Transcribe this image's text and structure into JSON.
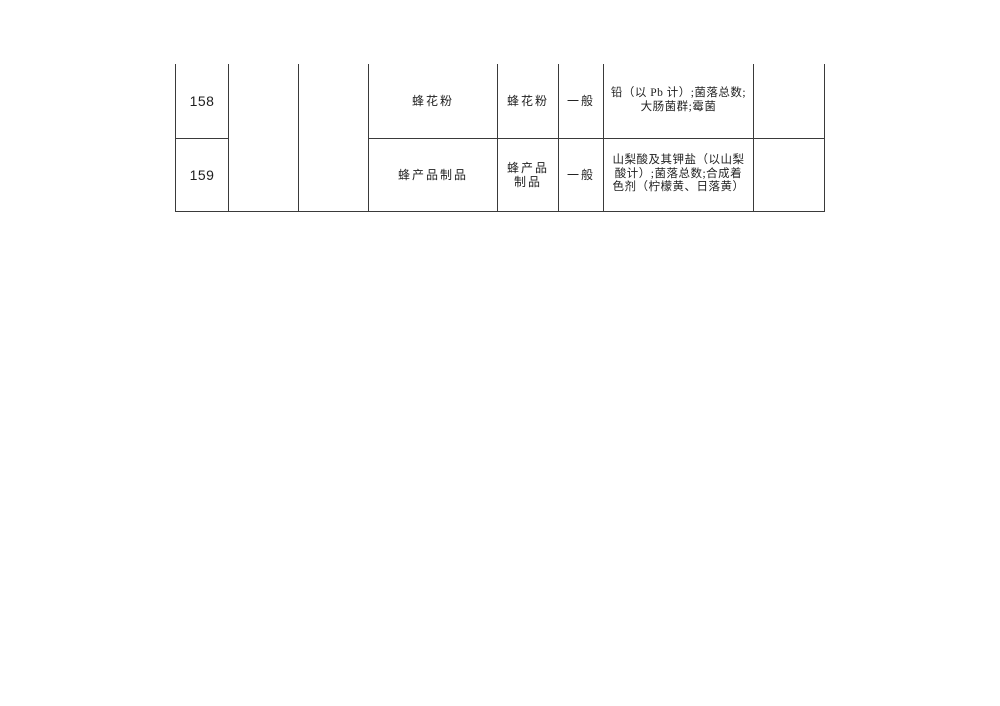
{
  "document": {
    "background_color": "#ffffff",
    "text_color": "#1f1f1f",
    "border_color": "#3a3a3a"
  },
  "table": {
    "description": "table-fragment-cut-off-at-top",
    "merged_blank_columns": [
      "",
      ""
    ],
    "rows": [
      {
        "no": "158",
        "product": "蜂花粉",
        "category": "蜂花粉",
        "category_lines": [
          "蜂花粉"
        ],
        "grade": "一般",
        "test_items": "铅（以 Pb 计）;菌落总数;大肠菌群;霉菌",
        "test_items_lines": [
          "铅（以 Pb 计）;菌落总数;",
          "大肠菌群;霉菌"
        ],
        "remark": ""
      },
      {
        "no": "159",
        "product": "蜂产品制品",
        "category": "蜂产品制品",
        "category_lines": [
          "蜂产品",
          "制品"
        ],
        "grade": "一般",
        "test_items": "山梨酸及其钾盐（以山梨酸计）;菌落总数;合成着色剂（柠檬黄、日落黄）",
        "test_items_lines": [
          "山梨酸及其钾盐（以山梨",
          "酸计）;菌落总数;合成着",
          "色剂（柠檬黄、日落黄）"
        ],
        "remark": ""
      }
    ]
  }
}
